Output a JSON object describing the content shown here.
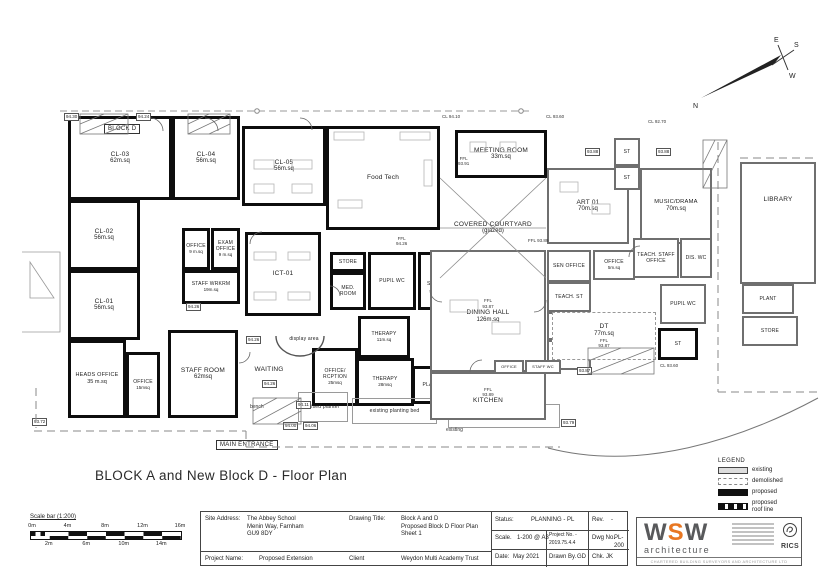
{
  "page": {
    "title": "BLOCK A and New Block D - Floor Plan"
  },
  "rooms": {
    "blockd": {
      "label": "BLOCK D"
    },
    "cl03": {
      "label": "CL-03",
      "area": "62m.sq"
    },
    "cl04": {
      "label": "CL-04",
      "area": "56m.sq"
    },
    "cl05": {
      "label": "CL-05",
      "area": "56m.sq"
    },
    "cl02": {
      "label": "CL-02",
      "area": "56m.sq"
    },
    "cl01": {
      "label": "CL-01",
      "area": "56m.sq"
    },
    "office9": {
      "label": "OFFICE",
      "area": "9 m.sq"
    },
    "exam9": {
      "label": "EXAM OFFICE",
      "area": "9 m.sq"
    },
    "wrkrm": {
      "label": "STAFF WRKRM",
      "area": "19m.sq"
    },
    "ict01": {
      "label": "ICT-01"
    },
    "foodtech": {
      "label": "Food Tech"
    },
    "heads": {
      "label": "HEADS OFFICE",
      "area": "35 m.sq"
    },
    "office15": {
      "label": "OFFICE",
      "area": "15msq"
    },
    "staffroom": {
      "label": "STAFF ROOM",
      "area": "62msq"
    },
    "waiting": {
      "label": "WAITING"
    },
    "display": {
      "label": "display area"
    },
    "store": {
      "label": "STORE"
    },
    "medroom": {
      "label": "MED. ROOM"
    },
    "pupilwc": {
      "label": "PUPIL WC"
    },
    "disshwr": {
      "label": "DIS. SHWR"
    },
    "therapy11": {
      "label": "THERAPY",
      "area": "11m.sq"
    },
    "offrcp": {
      "label": "OFFICE/ RCPTION",
      "area": "25msq"
    },
    "therapy28": {
      "label": "THERAPY",
      "area": "28msq"
    },
    "plantS": {
      "label": "PLANT"
    },
    "raisedplanter": {
      "label": "raised planter"
    },
    "bed1": {
      "label": "existing planting bed"
    },
    "bed2": {
      "label": "existing planting bed"
    },
    "meeting": {
      "label": "MEETING ROOM",
      "area": "33m.sq"
    },
    "courtyard": {
      "label": "COVERED COURTYARD",
      "sub": "(glazed)"
    },
    "art01": {
      "label": "ART 01",
      "area": "70m.sq"
    },
    "musicdrama": {
      "label": "MUSIC/DRAMA",
      "area": "70m.sq"
    },
    "stA": {
      "label": "ST"
    },
    "stB": {
      "label": "ST"
    },
    "dining": {
      "label": "DINING HALL",
      "area": "126m.sq"
    },
    "senoffice": {
      "label": "SEN OFFICE"
    },
    "teachst1": {
      "label": "TEACH. ST"
    },
    "adminst": {
      "label": "ADMIN ST"
    },
    "teachst2": {
      "label": "TEACH. ST"
    },
    "office5": {
      "label": "OFFICE",
      "area": "5m.sq"
    },
    "teachstaff": {
      "label": "TEACH. STAFF OFFICE"
    },
    "diswc": {
      "label": "DIS. WC"
    },
    "dt": {
      "label": "DT",
      "area": "77m.sq"
    },
    "stDT": {
      "label": "ST"
    },
    "kitchen": {
      "label": "KITCHEN"
    },
    "officeK": {
      "label": "OFFICE"
    },
    "staffwcK": {
      "label": "STAFF WC"
    },
    "pupilwcR": {
      "label": "PUPIL WC"
    },
    "plantR": {
      "label": "PLANT"
    },
    "storeR": {
      "label": "STORE"
    },
    "library": {
      "label": "LIBRARY"
    }
  },
  "annotations": {
    "main_entrance": "MAIN ENTRANCE",
    "bench": "bench",
    "existing": "existing"
  },
  "levels": {
    "l1": "94.30",
    "l2": "94.24",
    "l3": "94.26",
    "l4": "94.26",
    "l5": "94.26",
    "l6": "94.11",
    "l7": "94.00",
    "l8": "94.06",
    "l9": "93.72",
    "l10": "93.88",
    "l11": "93.88",
    "l12": "93.87",
    "l13": "93.79",
    "cl1": "CL 94.10",
    "cl2": "CL 93.60",
    "cl3": "CL 92.70",
    "cl4": "CL 93.60",
    "ffl1": "FFL\n94.26",
    "ffl2": "FFL\n93.91",
    "ffl3": "FFL 93.89",
    "ffl4": "FFL\n93.87",
    "ffl5": "FFL\n93.87",
    "ffl6": "FFL\n93.89"
  },
  "compass": {
    "n": "N",
    "e": "E",
    "s": "S",
    "w": "W"
  },
  "legend": {
    "title": "LEGEND",
    "items": [
      {
        "label": "existing"
      },
      {
        "label": "demolished"
      },
      {
        "label": "proposed"
      },
      {
        "label": "proposed\nroof line"
      }
    ]
  },
  "scalebar": {
    "title": "Scale bar (1:200)",
    "top": [
      "0m",
      "4m",
      "8m",
      "12m",
      "16m"
    ],
    "bottom": [
      "2m",
      "6m",
      "10m",
      "14m"
    ]
  },
  "titleblock": {
    "site_address_label": "Site Address:",
    "site_address": "The Abbey School\nMenin Way, Farnham\nGU9 8DY",
    "drawing_title_label": "Drawing Title:",
    "drawing_title": "Block A and D\nProposed Block D Floor Plan\nSheet 1",
    "status_label": "Status:",
    "status": "PLANNING - PL",
    "rev_label": "Rev.",
    "rev": "-",
    "scale_label": "Scale.",
    "scale": "1-200 @ A3",
    "project_no_label": "Project No. -",
    "project_no": "2019.75.4.4",
    "dwg_no_label": "Dwg No.",
    "dwg_no": "PL-200",
    "date_label": "Date:",
    "date": "May 2021",
    "drawn_label": "Drawn By.",
    "drawn": "GD",
    "chk_label": "Chk.",
    "chk": "JK",
    "project_name_label": "Project Name:",
    "project_name": "Proposed Extension",
    "client_label": "Client",
    "client": "Weydon Multi Academy Trust"
  },
  "logo": {
    "w1": "W",
    "s": "S",
    "w2": "W",
    "sub": "architecture",
    "tagline": "CHARTERED BUILDING SURVEYORS AND ARCHITECTURE LTD",
    "rics": "RICS"
  }
}
